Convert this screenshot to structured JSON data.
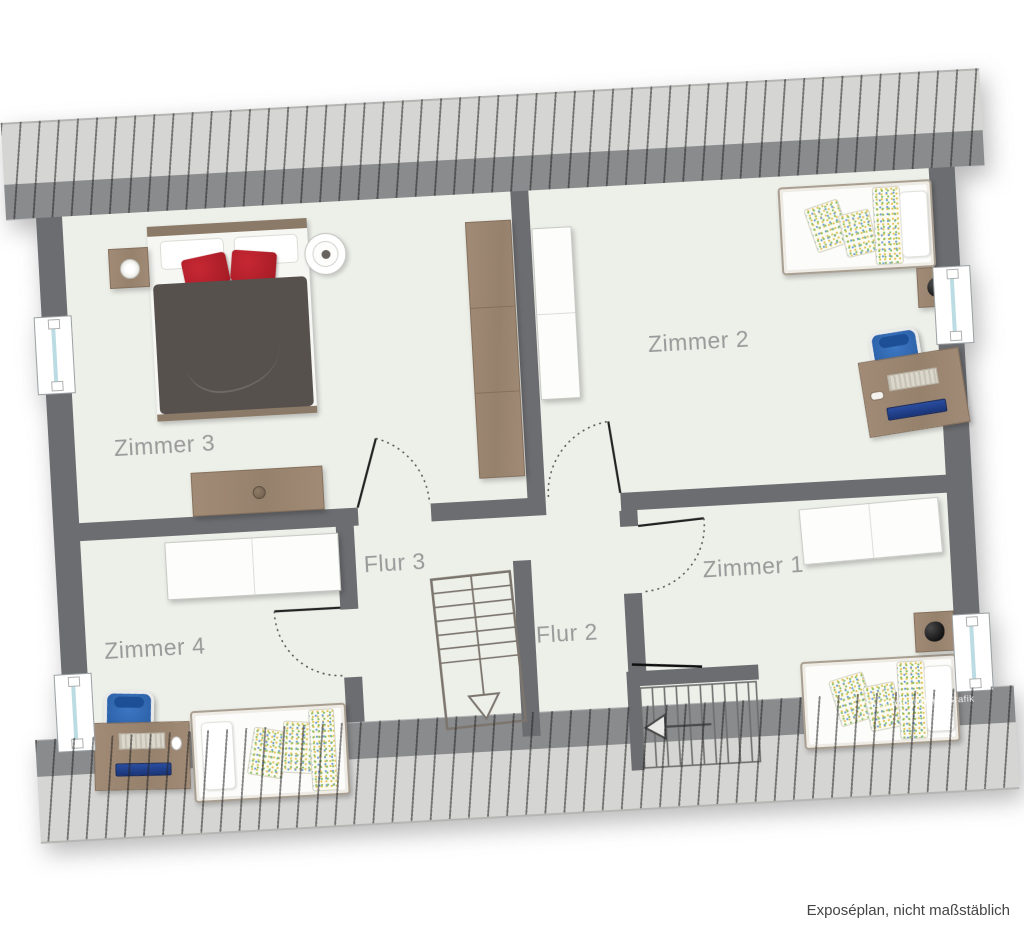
{
  "page": {
    "caption": "Exposéplan, nicht maßstäblich",
    "background": "#ffffff"
  },
  "plan": {
    "watermark": "Illustration©ImmoGrafik",
    "rotation_deg": -3.2,
    "colors": {
      "floor": "#edefe9",
      "wall": "#6c6d71",
      "roof_hatch_light": "#d5d5d3",
      "roof_hatch_dark": "#8a8b8d",
      "label_text": "#9a9a9a",
      "wood_furniture": "#9d8874",
      "bed_duvet": "#57514e",
      "pillow_red": "#b6202b",
      "chair_blue": "#2d62a9",
      "monitor_blue": "#20418f",
      "window_glass": "#bcdce4"
    },
    "rooms": [
      {
        "id": "zimmer-3",
        "label": "Zimmer 3"
      },
      {
        "id": "zimmer-2",
        "label": "Zimmer 2"
      },
      {
        "id": "flur-3",
        "label": "Flur 3"
      },
      {
        "id": "flur-2",
        "label": "Flur 2"
      },
      {
        "id": "zimmer-4",
        "label": "Zimmer 4"
      },
      {
        "id": "zimmer-1",
        "label": "Zimmer 1"
      }
    ]
  }
}
